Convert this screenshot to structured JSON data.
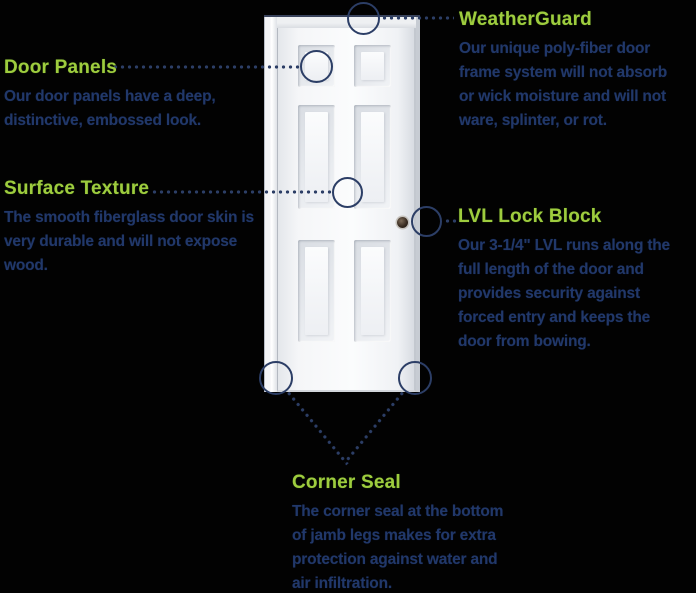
{
  "canvas": {
    "width": 696,
    "height": 593,
    "background": "#000000"
  },
  "colors": {
    "heading_green": "#9ECC3E",
    "body_navy": "#21386A",
    "leader_navy": "#2C3E66",
    "door_white": "#F7F8FA"
  },
  "icons": {
    "callout_circle": "navy-outline-ring",
    "knob_bore": "dark-circle",
    "leader": "navy-dotted-line"
  },
  "callouts": {
    "weatherguard": {
      "title": "WeatherGuard",
      "lines": [
        "Our unique poly-fiber door",
        "frame system will not absorb",
        "or wick moisture and will not",
        "ware, splinter, or rot."
      ]
    },
    "door_panels": {
      "title": "Door Panels",
      "lines": [
        "Our door panels have a deep,",
        "distinctive, embossed look."
      ]
    },
    "surface_texture": {
      "title": "Surface Texture",
      "lines": [
        "The smooth fiberglass door skin is",
        "very durable and will not expose",
        "wood."
      ]
    },
    "lvl_lock_block": {
      "title": "LVL Lock Block",
      "lines": [
        "Our 3-1/4\" LVL runs along the",
        "full length of the door and",
        "provides security against",
        "forced entry and keeps the",
        "door from bowing."
      ]
    },
    "corner_seal": {
      "title": "Corner Seal",
      "lines": [
        "The corner seal at the bottom",
        "of jamb legs makes for extra",
        "protection against water and",
        "air infiltration."
      ]
    }
  }
}
